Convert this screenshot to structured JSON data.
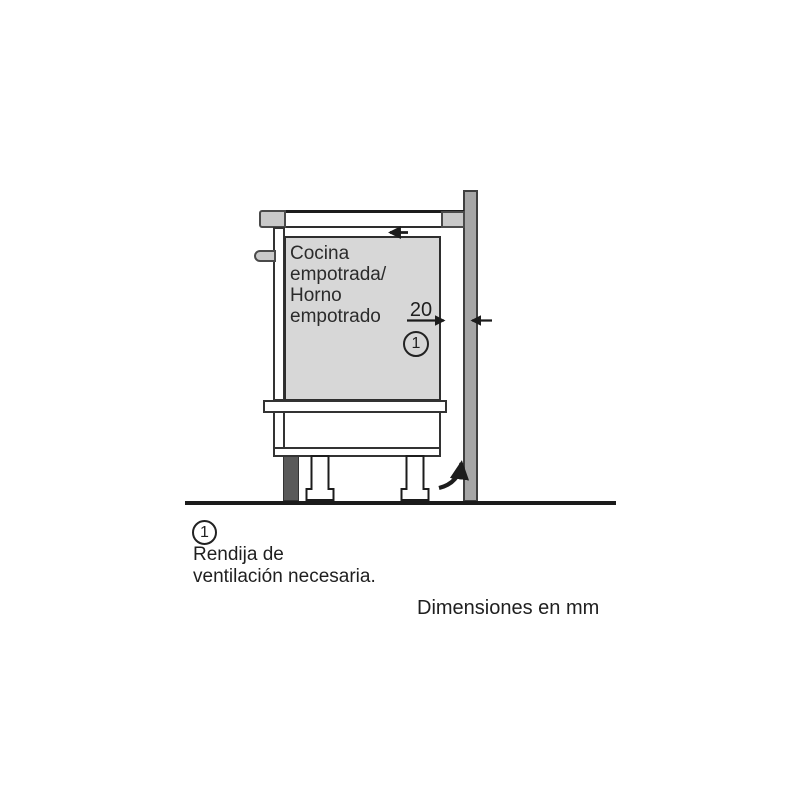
{
  "figure": {
    "type": "appliance-installation-diagram",
    "cabinet_label": "Cocina\nempotrada/\nHorno\nempotrado",
    "gap_dimension_mm": "20",
    "callout": {
      "number": "1"
    },
    "legend": {
      "number": "1",
      "description": "Rendija de\nventilación necesaria."
    },
    "units_note": "Dimensiones en mm",
    "colors": {
      "oven_body_fill": "#d7d7d7",
      "wall_fill": "#a6a6a6",
      "trim_fill": "#c9c9c9",
      "plinth_fill": "#5a5a5a",
      "line": "#222222",
      "background": "#ffffff"
    }
  }
}
